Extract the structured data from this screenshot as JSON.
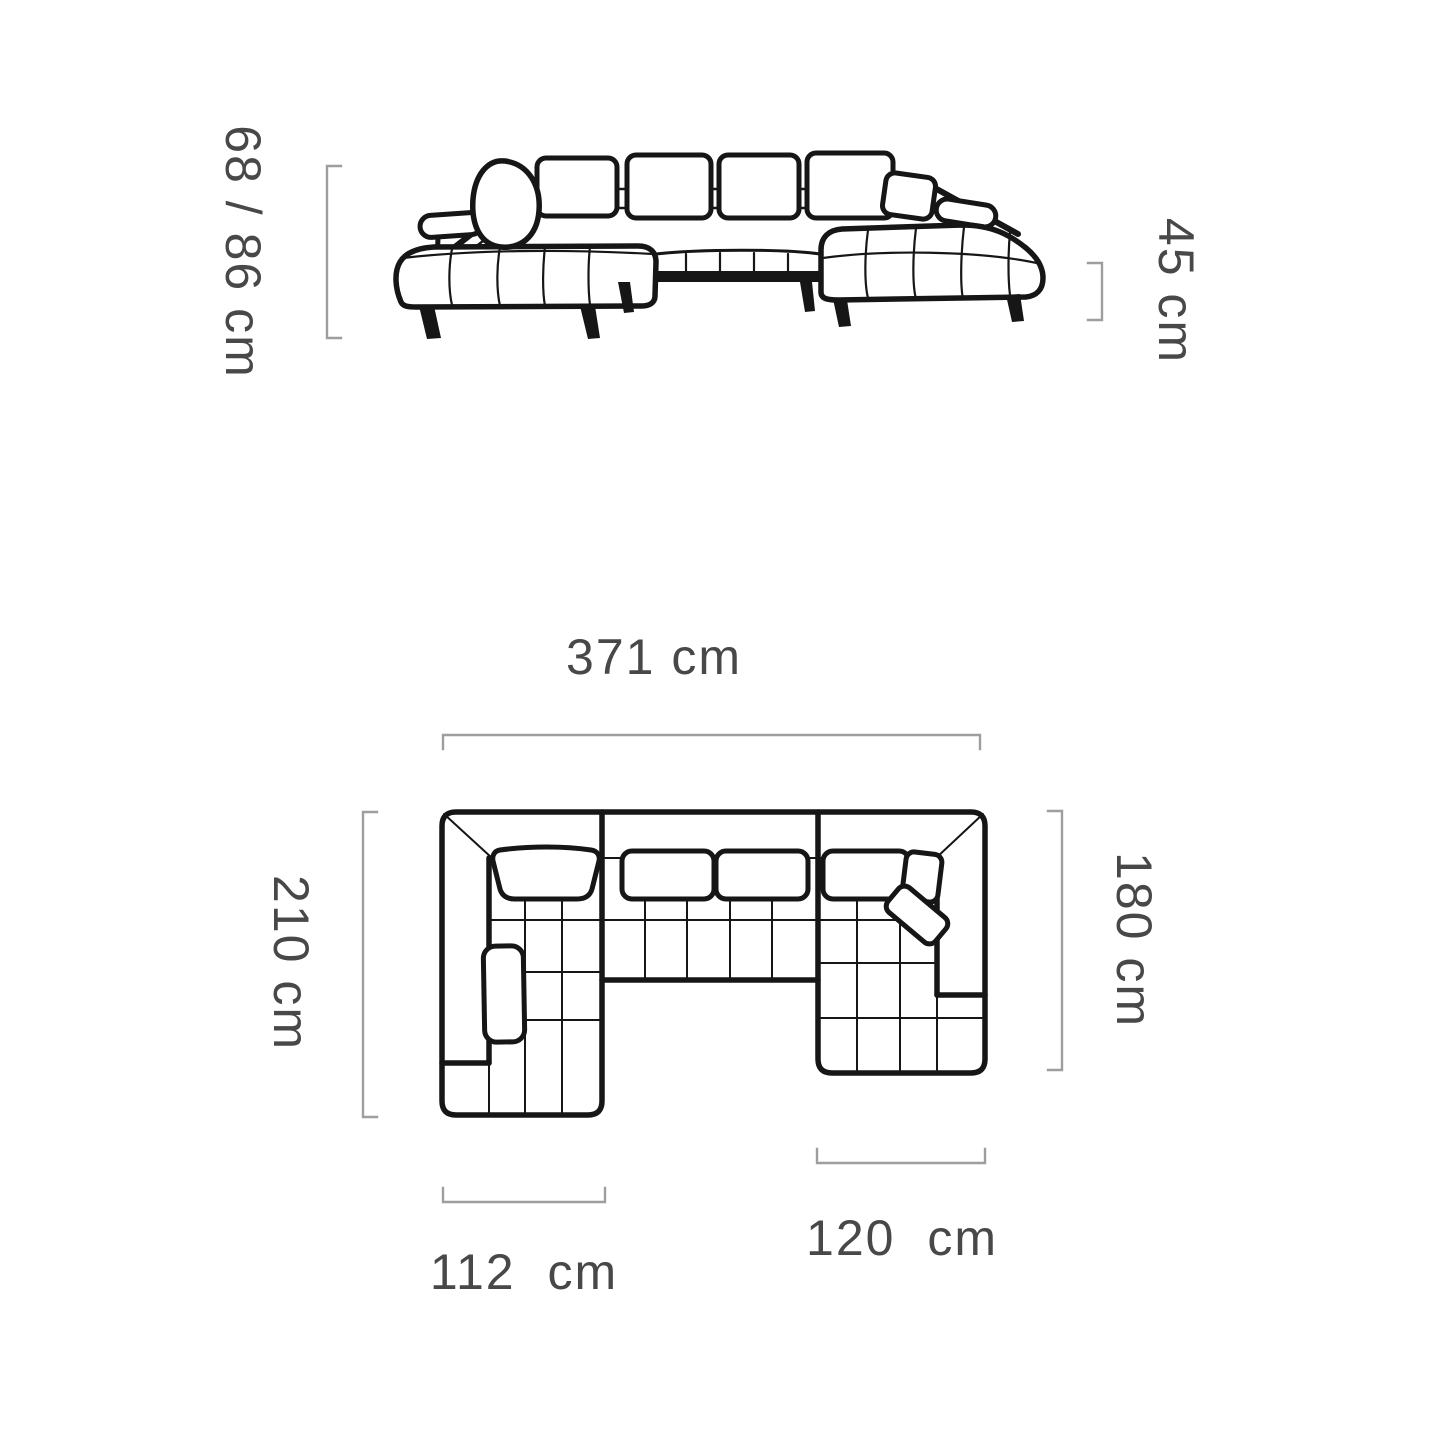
{
  "view": {
    "type": "product-dimension-diagram",
    "product": "u-shaped-corner-sofa",
    "views": [
      "front-elevation",
      "top-plan"
    ]
  },
  "labels": {
    "back_height": "68 / 86 cm",
    "seat_height": "45 cm",
    "total_width": "371 cm",
    "left_depth": "210 cm",
    "right_depth": "180 cm",
    "left_chaise_width": "112 cm",
    "right_chaise_width": "120 cm"
  },
  "colors": {
    "background": "#ffffff",
    "line_art": "#161616",
    "dimension_line": "#9e9e9e",
    "label_text": "#484848"
  }
}
